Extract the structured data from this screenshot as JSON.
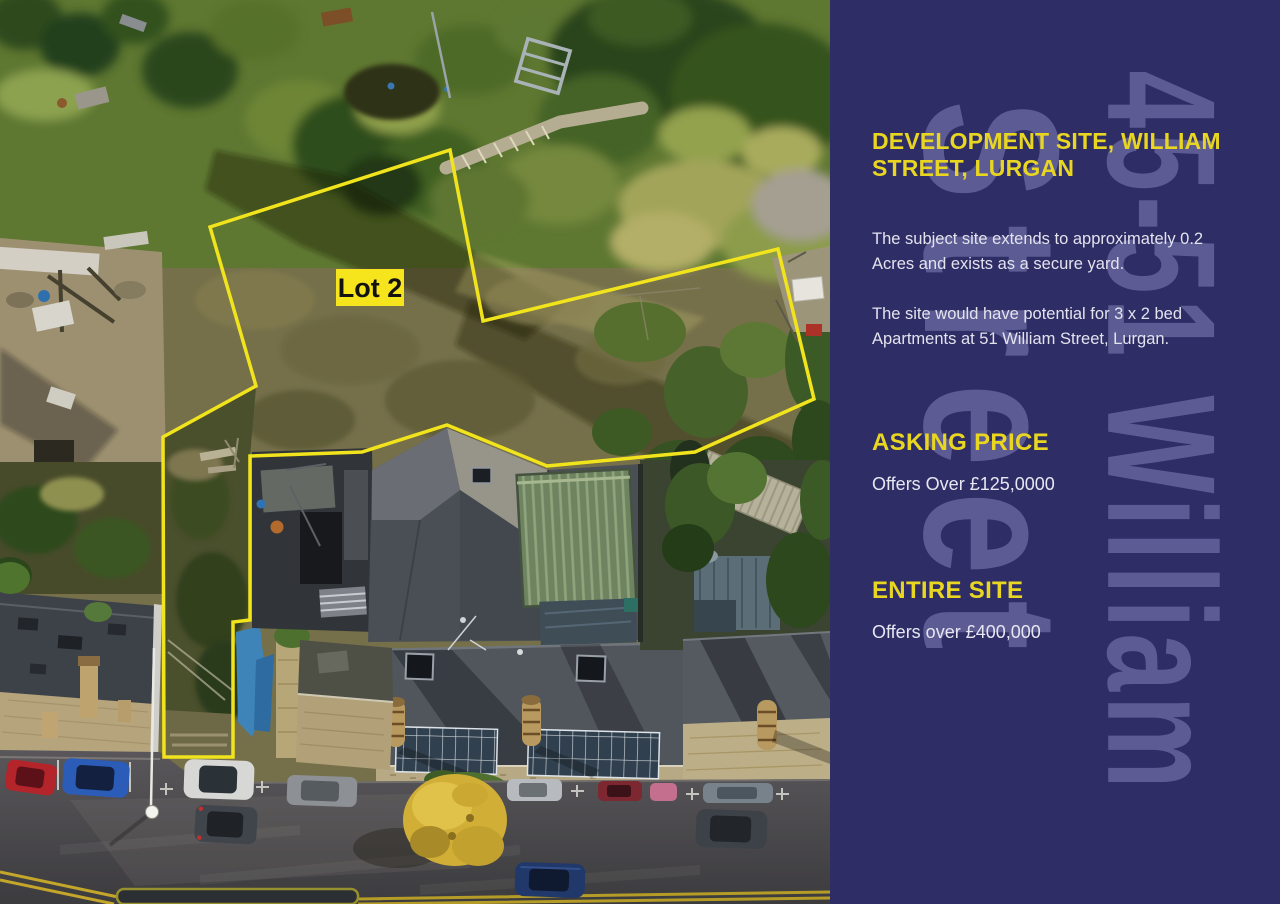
{
  "photo": {
    "lot_label": "Lot 2"
  },
  "panel": {
    "watermark_line1": "45-51 William",
    "watermark_line2": "Street",
    "heading": "DEVELOPMENT SITE, WILLIAM STREET, LURGAN",
    "paragraphs": [
      "The subject site extends to approximately 0.2 Acres and exists as a secure yard.",
      "The site would have potential for 3 x 2 bed Apartments at 51 William Street, Lurgan."
    ],
    "sections": [
      {
        "label": "ASKING PRICE",
        "value": "Offers Over £125,0000"
      },
      {
        "label": "ENTIRE SITE",
        "value": "Offers over £400,000"
      }
    ]
  },
  "colors": {
    "panel_bg": "#2f2d66",
    "accent_yellow": "#e9d621",
    "watermark": "#5c5b93",
    "body_text": "#e3e3ee",
    "boundary_yellow": "#f2e41c",
    "lot_label_bg": "#f6e51d"
  }
}
